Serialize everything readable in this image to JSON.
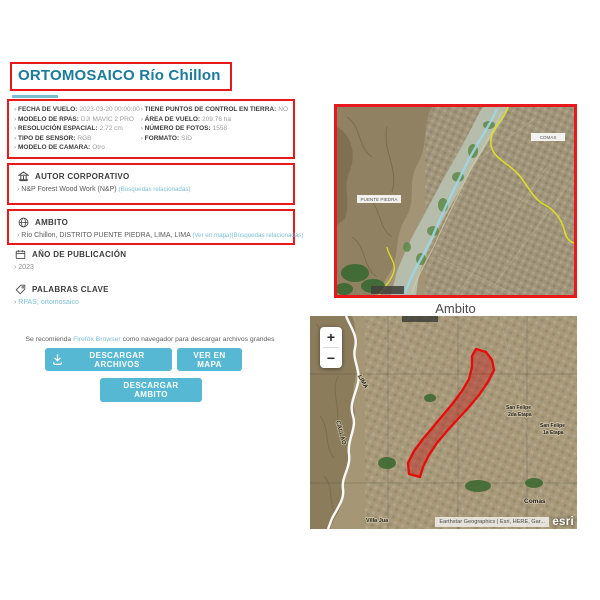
{
  "title": "ORTOMOSAICO Río Chillon",
  "metadata": {
    "left": [
      {
        "label": "FECHA DE VUELO:",
        "value": "2023-03-20 00:00:00"
      },
      {
        "label": "MODELO DE RPAS:",
        "value": "DJI MAVIC 2 PRO"
      },
      {
        "label": "RESOLUCIÓN ESPACIAL:",
        "value": "2.72 cm"
      },
      {
        "label": "TIPO DE SENSOR:",
        "value": "RGB"
      },
      {
        "label": "MODELO DE CAMARA:",
        "value": "Otro"
      }
    ],
    "right": [
      {
        "label": "TIENE PUNTOS DE CONTROL EN TIERRA:",
        "value": "NO"
      },
      {
        "label": "ÁREA DE VUELO:",
        "value": "209.76 ha"
      },
      {
        "label": "NÚMERO DE FOTOS:",
        "value": "1558"
      },
      {
        "label": "FORMATO:",
        "value": "SID"
      }
    ]
  },
  "autor": {
    "heading": "AUTOR CORPORATIVO",
    "name": "N&P Forest Wood Work (N&P)",
    "related_link": "(Búsquedas relacionadas)"
  },
  "ambito": {
    "heading": "AMBITO",
    "location": "Río Chillon, DISTRITO PUENTE PIEDRA, LIMA, LIMA",
    "map_link": "(Ver en mapa)",
    "related_link": "(Búsquedas relacionadas)"
  },
  "publicacion": {
    "heading": "AÑO DE PUBLICACIÓN",
    "year": "2023"
  },
  "palabras": {
    "heading": "PALABRAS CLAVE",
    "keywords": "RPAS, ortomosaico"
  },
  "note": {
    "before": "Se recomienda ",
    "link": "Firefox Browser",
    "after": " como navegador para descargar archivos grandes"
  },
  "buttons": {
    "download_files": "DESCARGAR ARCHIVOS",
    "view_map": "VER EN MAPA",
    "download_ambito": "DESCARGAR AMBITO"
  },
  "top_map": {
    "caption": "Ambito",
    "label_left": "PUENTE PIEDRA",
    "label_right": "COMAS"
  },
  "bottom_map": {
    "zoom_in": "+",
    "zoom_out": "−",
    "label_lima": "LIMA",
    "label_callao": "CALLAO",
    "sf2_line1": "San Felipe",
    "sf2_line2": "2da Etapa",
    "sf1_line1": "San Felipe",
    "sf1_line2": "1a Etapa",
    "label_comas": "Comas",
    "label_villa": "Villa Jua",
    "attribution": "Earthstar Geographics | Esri, HERE, Gar...",
    "esri": "esri"
  }
}
